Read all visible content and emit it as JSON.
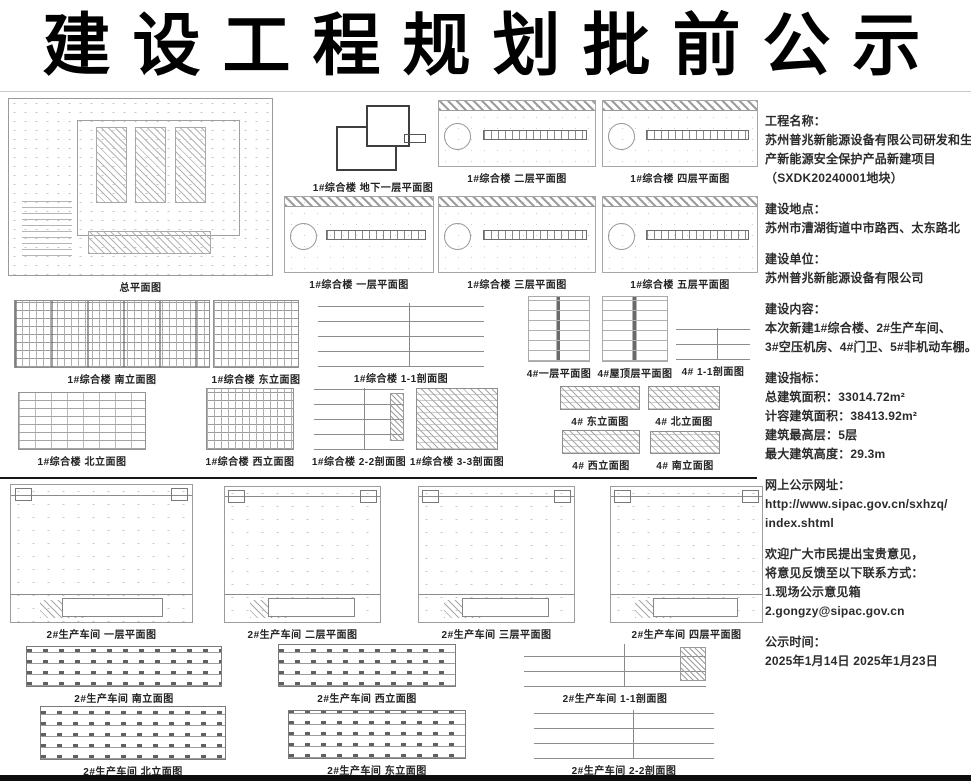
{
  "title": "建设工程规划批前公示",
  "drawings": {
    "site": "总平面图",
    "b1": "1#综合楼 地下一层平面图",
    "f2": "1#综合楼 二层平面图",
    "f4": "1#综合楼 四层平面图",
    "f1": "1#综合楼 一层平面图",
    "f3": "1#综合楼 三层平面图",
    "f5": "1#综合楼 五层平面图",
    "south1": "1#综合楼 南立面图",
    "east1": "1#综合楼 东立面图",
    "sec11_1": "1#综合楼 1-1剖面图",
    "north1": "1#综合楼 北立面图",
    "west1": "1#综合楼 西立面图",
    "sec22_1": "1#综合楼 2-2剖面图",
    "sec33_1": "1#综合楼 3-3剖面图",
    "g4_plan1": "4#一层平面图",
    "g4_roof": "4#屋顶层平面图",
    "g4_sec11": "4# 1-1剖面图",
    "g4_east": "4# 东立面图",
    "g4_north": "4# 北立面图",
    "g4_west": "4# 西立面图",
    "g4_south": "4# 南立面图",
    "w2_p1": "2#生产车间 一层平面图",
    "w2_p2": "2#生产车间 二层平面图",
    "w2_p3": "2#生产车间 三层平面图",
    "w2_p4": "2#生产车间 四层平面图",
    "w2_south": "2#生产车间 南立面图",
    "w2_west": "2#生产车间 西立面图",
    "w2_sec11": "2#生产车间 1-1剖面图",
    "w2_north": "2#生产车间 北立面图",
    "w2_east": "2#生产车间 东立面图",
    "w2_sec22": "2#生产车间 2-2剖面图"
  },
  "info": {
    "sections": [
      {
        "heading": "工程名称：",
        "lines": [
          "苏州普兆新能源设备有限公司研发和生",
          "产新能源安全保护产品新建项目",
          "（SXDK20240001地块）"
        ]
      },
      {
        "heading": "建设地点：",
        "lines": [
          "苏州市漕湖街道中市路西、太东路北"
        ]
      },
      {
        "heading": "建设单位：",
        "lines": [
          "苏州普兆新能源设备有限公司"
        ]
      },
      {
        "heading": "建设内容：",
        "lines": [
          "本次新建1#综合楼、2#生产车间、",
          "3#空压机房、4#门卫、5#非机动车棚。"
        ]
      },
      {
        "heading": "建设指标：",
        "lines": [
          "总建筑面积：33014.72m²",
          "计容建筑面积：38413.92m²",
          "建筑最高层：5层",
          "最大建筑高度：29.3m"
        ]
      },
      {
        "heading": "网上公示网址：",
        "lines": [
          "http://www.sipac.gov.cn/sxhzq/",
          "index.shtml"
        ]
      },
      {
        "heading": "欢迎广大市民提出宝贵意见，",
        "lines": [
          "将意见反馈至以下联系方式：",
          "1.现场公示意见箱",
          "2.gongzy@sipac.gov.cn"
        ]
      },
      {
        "heading": "公示时间：",
        "lines": [
          "2025年1月14日  2025年1月23日"
        ]
      }
    ]
  }
}
